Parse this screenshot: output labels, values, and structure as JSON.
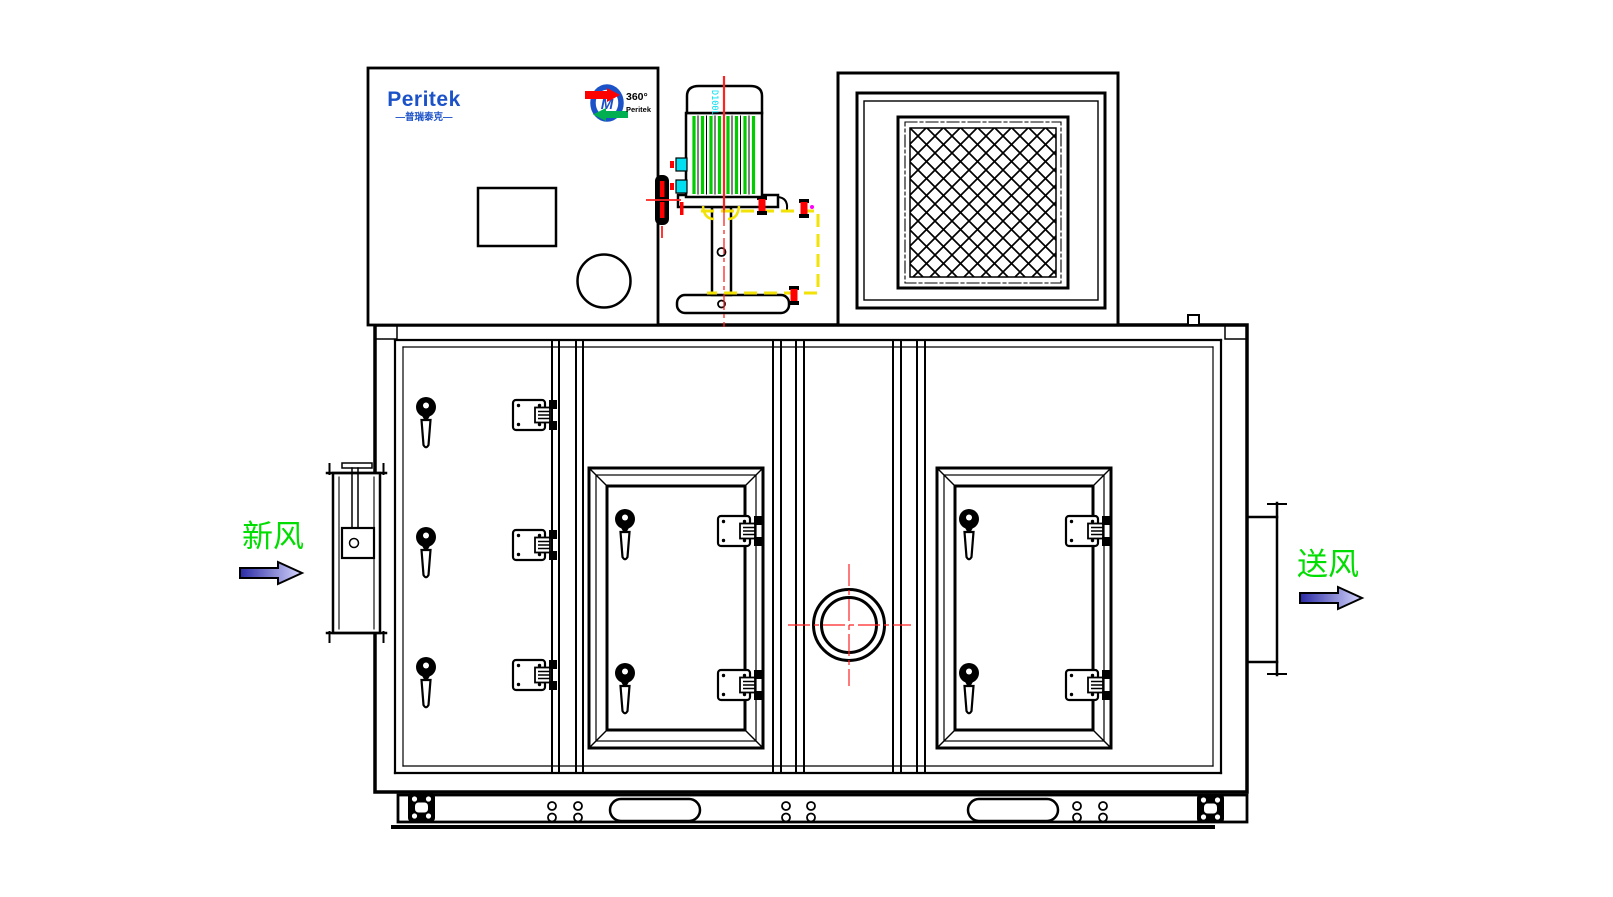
{
  "labels": {
    "fresh_air": "新风",
    "supply_air": "送风"
  },
  "brand": {
    "name": "Peritek",
    "subtitle": "—普瑞泰克—",
    "badge_degree": "360°",
    "badge_name": "Peritek"
  },
  "motor": {
    "model": "D100L"
  },
  "icons": {
    "flow_arrow": "right-pointing-flow-arrow",
    "door_handle": "wing-latch-handle",
    "door_latch": "hinge-latch-block",
    "rotation_badge": "circular-rotation-arrows-logo",
    "mesh": "diamond-mesh-filter",
    "crosshair": "red-centerline-crosshair"
  },
  "colors": {
    "background": "#ffffff",
    "line_black": "#000000",
    "label_green": "#00dd00",
    "stripe_green": "#00cc00",
    "centerline_red": "#ff2222",
    "fastener_red": "#ff0000",
    "hatch_yellow": "#f2e205",
    "accent_cyan": "#00e0f0",
    "accent_magenta": "#ff00ff",
    "logo_blue": "#1c52c8",
    "logo_green": "#00b050",
    "arrow_dark_blue": "#2a2aa4",
    "arrow_light_blue": "#d8d8ff"
  }
}
